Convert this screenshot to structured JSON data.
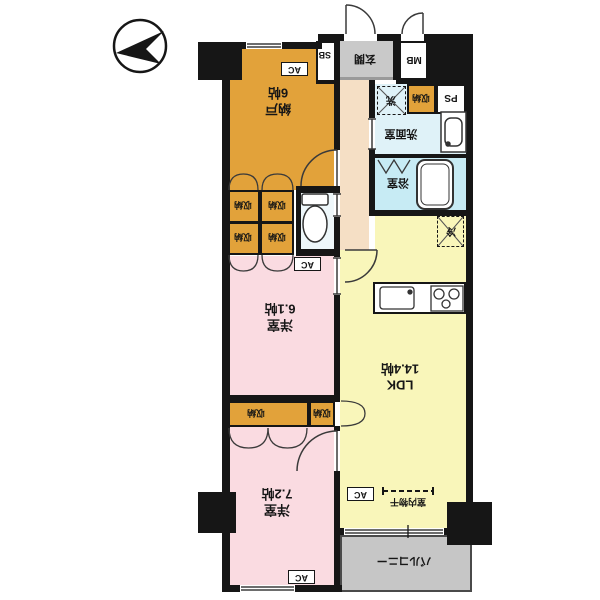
{
  "title": "マンション間取り図",
  "colors": {
    "wall": "#161616",
    "storage_orange": "#e2a23a",
    "bedroom_pink": "#fadbe1",
    "ldk_yellow": "#f9f6ba",
    "bath_cyan": "#c7ebf4",
    "washroom_cyan": "#dff2f8",
    "toilet_pale": "#eef7fa",
    "hall_cream": "#f5dfc5",
    "gray": "#c6c6c6"
  },
  "rooms": {
    "nando": {
      "label": "納戸",
      "area": "6帖"
    },
    "bedroom1": {
      "label": "洋室",
      "area": "6.1帖"
    },
    "bedroom2": {
      "label": "洋室",
      "area": "7.2帖"
    },
    "ldk": {
      "label": "LDK",
      "area": "14.4帖"
    },
    "balcony": {
      "label": "バルコニー"
    },
    "entrance": {
      "label": "玄関"
    },
    "washroom": {
      "label": "洗面室"
    },
    "bathroom": {
      "label": "浴室"
    }
  },
  "labels": {
    "closet": "収納",
    "ac": "AC",
    "mb": "MB",
    "sb": "SB",
    "ps": "PS",
    "laundry": "洗",
    "fridge": "冷",
    "indoor_drying": "室内物干"
  }
}
